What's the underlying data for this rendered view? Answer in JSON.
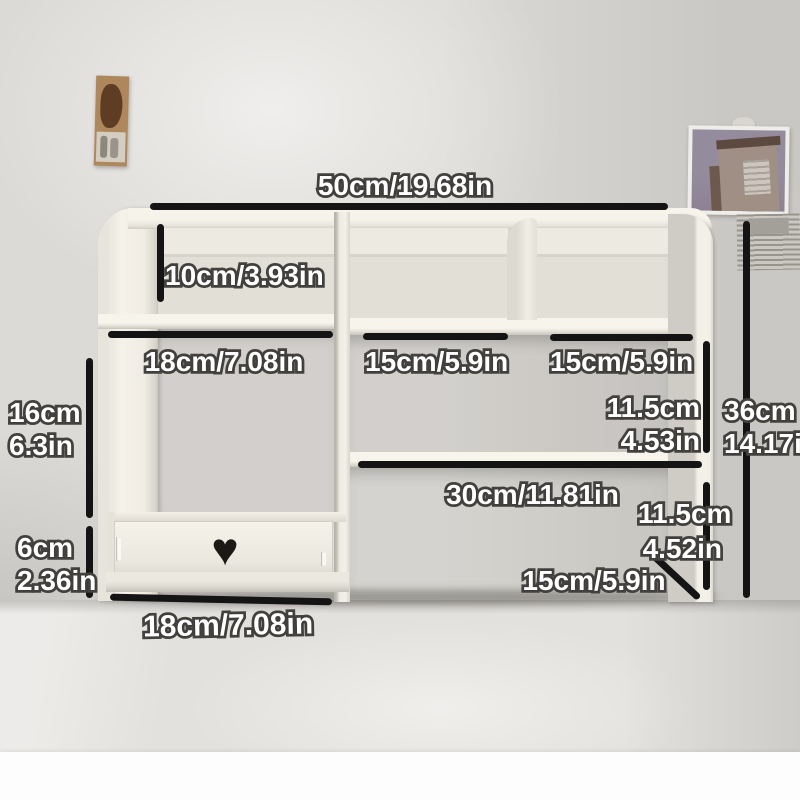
{
  "scene_title": "Desktop shelf with dimension annotations",
  "dimensions": {
    "top_width": "50cm/19.68in",
    "upper_left_cubby_height": "10cm/3.93in",
    "left_section_width": "18cm/7.08in",
    "middle_shelf_width": "15cm/5.9in",
    "right_shelf_width": "15cm/5.9in",
    "left_opening_height_cm": "16cm",
    "left_opening_height_in": "6.3in",
    "middle_row_height_cm": "11.5cm",
    "middle_row_height_in": "4.53in",
    "overall_height_cm": "36cm",
    "overall_height_in": "14.17in",
    "lower_shelf_width": "30cm/11.81in",
    "lower_right_height_cm": "11.5cm",
    "lower_right_height_in": "4.52in",
    "drawer_height_cm": "6cm",
    "drawer_height_in": "2.36in",
    "base_depth": "15cm/5.9in",
    "drawer_width": "18cm/7.08in"
  },
  "icons": {
    "heart_cutout": "♥"
  },
  "colors": {
    "dimension_line": "#141414",
    "label_text": "#ffffff",
    "label_outline": "#454340",
    "furniture_cream": "#f2efe7",
    "wall_gray": "#dcdad6",
    "desk_gray": "#e3e1dd",
    "heart_cutout": "#1a1916",
    "bottom_margin": "#fdfdfd"
  }
}
